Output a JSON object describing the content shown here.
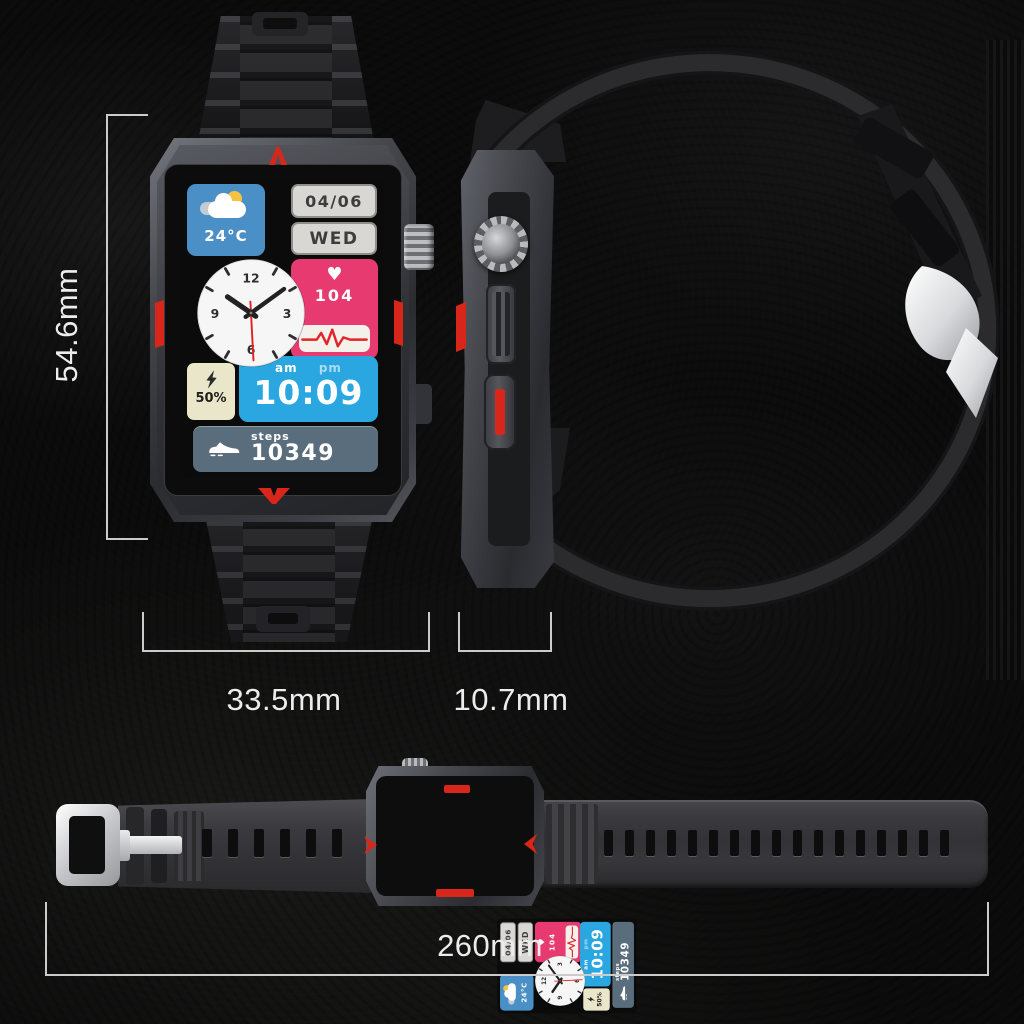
{
  "dimensions": {
    "height": "54.6mm",
    "width": "33.5mm",
    "thickness": "10.7mm",
    "strap_length": "260mm"
  },
  "watch_face": {
    "date": "04/06",
    "day": "WED",
    "temperature": "24°C",
    "heart_rate": "104",
    "am_label": "am",
    "pm_label": "pm",
    "time": "10:09",
    "battery": "50%",
    "steps_label": "steps",
    "steps_value": "10349",
    "clock": {
      "n12": "12",
      "n3": "3",
      "n6": "6",
      "n9": "9"
    }
  },
  "colors": {
    "accent_red": "#d8261b",
    "tile_blue": "#4a8fc5",
    "tile_cyan": "#2aa7e0",
    "tile_pink": "#e63a70",
    "tile_cream": "#eae6c9",
    "tile_slate": "#5a6d7c",
    "date_tile_gray": "#d8d7d3",
    "dimension_line": "#cbcbcb"
  }
}
